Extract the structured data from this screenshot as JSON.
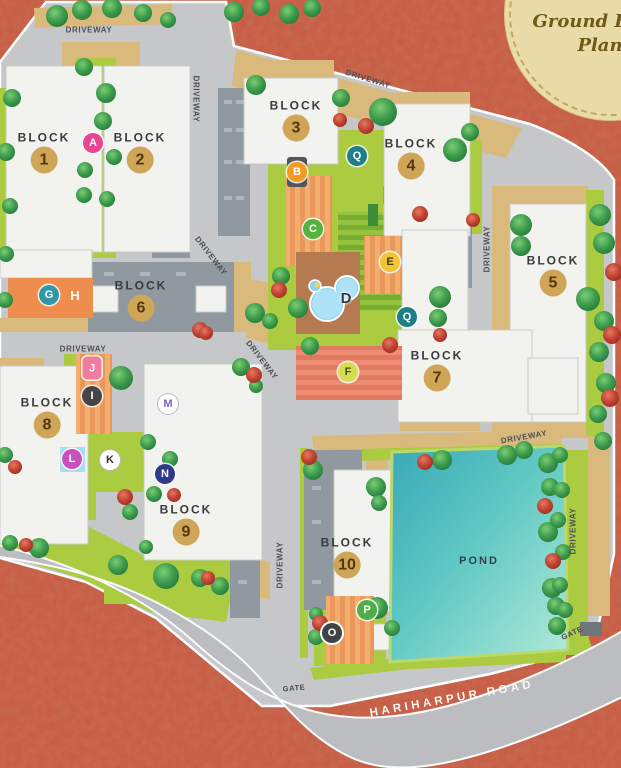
{
  "badge": {
    "title_line1": "Ground Floor",
    "title_line2": "Plan"
  },
  "labels": {
    "driveway": "DRIVEWAY",
    "gate": "GATE",
    "pond": "POND",
    "main_road": "HARIHARPUR ROAD"
  },
  "blocks": [
    {
      "label": "BLOCK",
      "number": "1"
    },
    {
      "label": "BLOCK",
      "number": "2"
    },
    {
      "label": "BLOCK",
      "number": "3"
    },
    {
      "label": "BLOCK",
      "number": "4"
    },
    {
      "label": "BLOCK",
      "number": "5"
    },
    {
      "label": "BLOCK",
      "number": "6"
    },
    {
      "label": "BLOCK",
      "number": "7"
    },
    {
      "label": "BLOCK",
      "number": "8"
    },
    {
      "label": "BLOCK",
      "number": "9"
    },
    {
      "label": "BLOCK",
      "number": "10"
    }
  ],
  "markers": [
    {
      "letter": "A",
      "color": "#e8468f"
    },
    {
      "letter": "B",
      "color": "#f29a22"
    },
    {
      "letter": "C",
      "color": "#55b23d"
    },
    {
      "letter": "D",
      "color": "#2e3b40"
    },
    {
      "letter": "E",
      "color": "#f2c335"
    },
    {
      "letter": "F",
      "color": "#d6dc52"
    },
    {
      "letter": "G",
      "color": "#2f99a8"
    },
    {
      "letter": "H",
      "color": "#ffffff"
    },
    {
      "letter": "I",
      "color": "#454545"
    },
    {
      "letter": "J",
      "color": "#f27ba0"
    },
    {
      "letter": "K",
      "color": "#ffffff"
    },
    {
      "letter": "L",
      "color": "#c94fc0"
    },
    {
      "letter": "M",
      "color": "#ffffff"
    },
    {
      "letter": "N",
      "color": "#2d3a8c"
    },
    {
      "letter": "O",
      "color": "#3f4346"
    },
    {
      "letter": "P",
      "color": "#4fae49"
    },
    {
      "letter": "Q",
      "color": "#1f7f88"
    }
  ],
  "palette": {
    "background": "#c65840",
    "site_ground": "#c6c7c9",
    "road": "#bcbdc0",
    "lawn": "#abcb41",
    "paving_tan": "#d9ba7c",
    "pond_water": "#57c2c0",
    "building": "#f2f2ef",
    "tree_green": "#3f9e4e",
    "tree_flowering": "#c44434",
    "block_badge": "#cfa558",
    "badge_cream": "#eadca9"
  }
}
